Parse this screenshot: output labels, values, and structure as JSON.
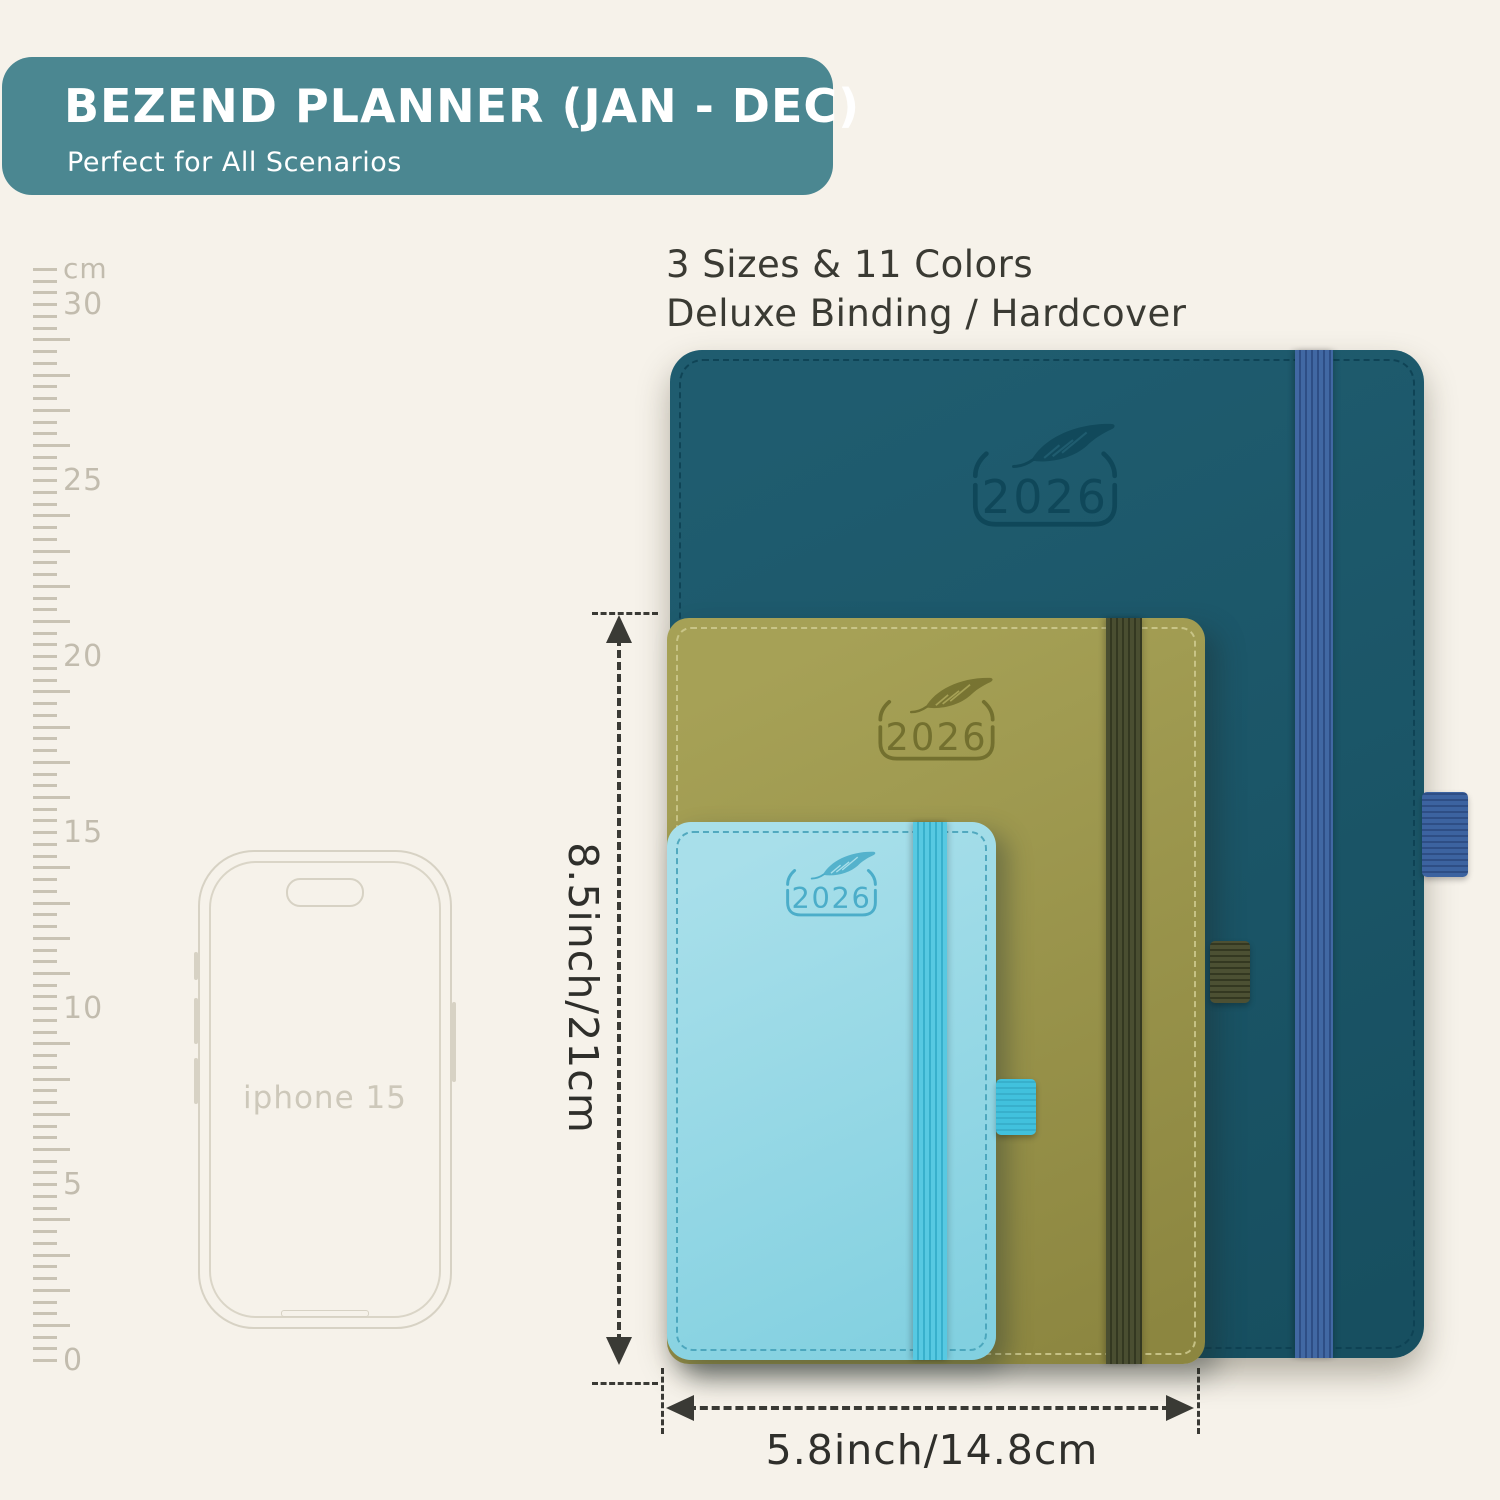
{
  "theme": {
    "background": "#f6f2ea",
    "banner_bg": "#4b8791",
    "arrow_color": "#3a3a35",
    "text_color": "#3a3a33",
    "ruler_tick_color": "#c9c3b4",
    "ruler_label_color": "#c2bcae",
    "phone_line_color": "#d7d2c4"
  },
  "banner": {
    "title": "BEZEND PLANNER (JAN - DEC)",
    "subtitle": "Perfect for All Scenarios"
  },
  "info": {
    "line1": "3 Sizes & 11 Colors",
    "line2": "Deluxe Binding / Hardcover"
  },
  "ruler": {
    "unit_label": "cm",
    "max_cm": 31,
    "cm_px": 35.2,
    "subdivisions_per_cm": 3,
    "numbered_every_cm": 5,
    "numbered_ticks": [
      "30",
      "25",
      "20",
      "15",
      "10",
      "5",
      "0"
    ]
  },
  "phone": {
    "label": "iphone 15"
  },
  "planners": [
    {
      "name": "planner-large-teal",
      "year": "2026",
      "colors": {
        "cover": "#1f5c6f",
        "cover2": "#174f60",
        "band": "#4168a3",
        "band_rib": "#2e4e85",
        "loop": "#3c63a0",
        "stitch": "#0d4052",
        "logo": "#0f4759"
      }
    },
    {
      "name": "planner-medium-olive",
      "year": "2026",
      "colors": {
        "cover": "#a6a156",
        "cover2": "#8c8640",
        "band": "#4a4e31",
        "band_rib": "#343821",
        "loop": "#4c5033",
        "stitch": "#cfcb90",
        "logo": "#73702f"
      }
    },
    {
      "name": "planner-small-skyblue",
      "year": "2026",
      "colors": {
        "cover": "#a8dfea",
        "cover2": "#82d0e0",
        "band": "#57c9e2",
        "band_rib": "#38b0cc",
        "loop": "#41c1dd",
        "stitch": "#43a0b8",
        "logo": "#4badc9"
      }
    }
  ],
  "dimensions": {
    "height_label": "8.5inch/21cm",
    "width_label": "5.8inch/14.8cm"
  }
}
